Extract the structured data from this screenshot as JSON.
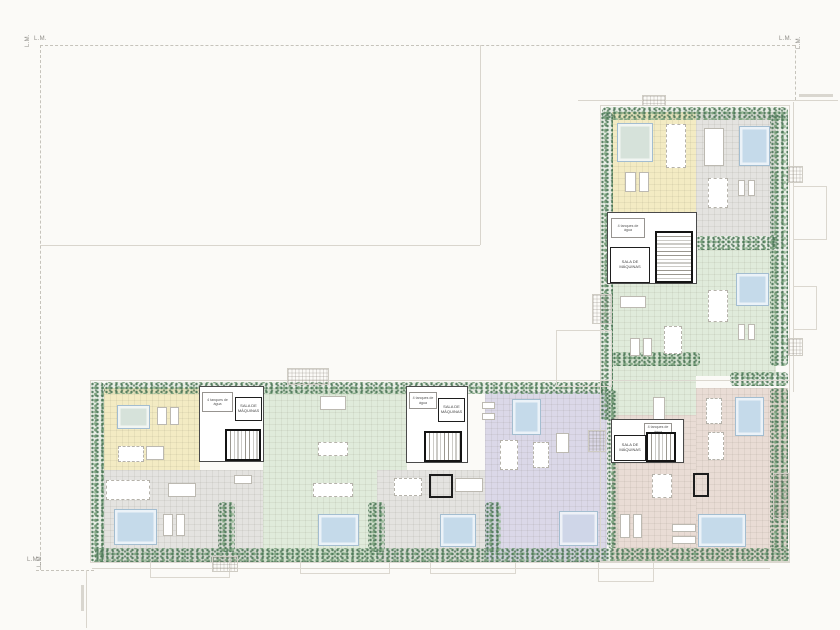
{
  "labels": {
    "lm": "L.M.",
    "sala_de_maquinas": "SALA DE\nMÁQUINAS",
    "tanques": "4 tanques de\nágua"
  },
  "palette": {
    "yellow": "#f3ebc3",
    "grey": "#e4e3e0",
    "green": "#e0ebdb",
    "purple": "#dbd8e8",
    "pink": "#e9dcd5",
    "pale": "#d6e2da",
    "blue": "#c5daea",
    "lav": "#cfd6e8",
    "boundary_dash": "#c6c3bb",
    "boundary_solid": "#d9d5cd"
  },
  "zones": [
    {
      "name": "yellow-north",
      "c": "yellow",
      "r": [
        612,
        112,
        84,
        102
      ]
    },
    {
      "name": "grey-north",
      "c": "grey",
      "r": [
        696,
        112,
        80,
        124
      ]
    },
    {
      "name": "green-north-right",
      "c": "green",
      "r": [
        696,
        250,
        80,
        126
      ]
    },
    {
      "name": "green-north-left",
      "c": "green",
      "r": [
        612,
        214,
        84,
        201
      ]
    },
    {
      "name": "pink-corner",
      "c": "pink",
      "r": [
        696,
        388,
        92,
        174
      ]
    },
    {
      "name": "pink-south",
      "c": "pink",
      "r": [
        612,
        415,
        84,
        147
      ]
    },
    {
      "name": "yellow-west",
      "c": "yellow",
      "r": [
        104,
        388,
        96,
        82
      ]
    },
    {
      "name": "grey-west",
      "c": "grey",
      "r": [
        104,
        470,
        159,
        92
      ]
    },
    {
      "name": "green-west",
      "c": "green",
      "r": [
        263,
        388,
        144,
        174
      ]
    },
    {
      "name": "grey-mid",
      "c": "grey",
      "r": [
        377,
        470,
        108,
        92
      ]
    },
    {
      "name": "purple",
      "c": "purple",
      "r": [
        485,
        392,
        122,
        170
      ]
    }
  ],
  "vegetation": [
    [
      602,
      107,
      186,
      13
    ],
    [
      600,
      112,
      13,
      308
    ],
    [
      770,
      114,
      18,
      252
    ],
    [
      696,
      236,
      80,
      14
    ],
    [
      730,
      372,
      58,
      14
    ],
    [
      612,
      352,
      88,
      14
    ],
    [
      770,
      388,
      18,
      162
    ],
    [
      104,
      382,
      503,
      12
    ],
    [
      90,
      382,
      14,
      180
    ],
    [
      95,
      548,
      695,
      14
    ],
    [
      218,
      502,
      17,
      50
    ],
    [
      368,
      502,
      17,
      50
    ],
    [
      485,
      502,
      16,
      50
    ],
    [
      607,
      390,
      11,
      158
    ]
  ],
  "pools": [
    {
      "r": [
        617,
        123,
        34,
        37
      ],
      "c": "pale"
    },
    {
      "r": [
        739,
        126,
        29,
        38
      ],
      "c": "blue"
    },
    {
      "r": [
        736,
        273,
        31,
        31
      ],
      "c": "blue"
    },
    {
      "r": [
        735,
        397,
        27,
        37
      ],
      "c": "blue"
    },
    {
      "r": [
        698,
        514,
        46,
        31
      ],
      "c": "blue"
    },
    {
      "r": [
        117,
        405,
        31,
        22
      ],
      "c": "pale"
    },
    {
      "r": [
        114,
        509,
        41,
        34
      ],
      "c": "blue"
    },
    {
      "r": [
        318,
        514,
        39,
        30
      ],
      "c": "blue"
    },
    {
      "r": [
        440,
        514,
        34,
        31
      ],
      "c": "blue"
    },
    {
      "r": [
        559,
        511,
        37,
        33
      ],
      "c": "lav"
    },
    {
      "r": [
        512,
        399,
        27,
        34
      ],
      "c": "blue"
    }
  ],
  "furniture": [
    {
      "t": "pair",
      "r": [
        625,
        172,
        24,
        20
      ]
    },
    {
      "t": "dots",
      "r": [
        666,
        124,
        20,
        44
      ]
    },
    {
      "t": "bar",
      "r": [
        704,
        128,
        20,
        38
      ]
    },
    {
      "t": "dots",
      "r": [
        708,
        178,
        20,
        30
      ]
    },
    {
      "t": "pair",
      "r": [
        738,
        180,
        17,
        16
      ]
    },
    {
      "t": "dots",
      "r": [
        708,
        290,
        20,
        32
      ]
    },
    {
      "t": "pair",
      "r": [
        738,
        324,
        17,
        16
      ]
    },
    {
      "t": "bar",
      "r": [
        620,
        296,
        26,
        12
      ]
    },
    {
      "t": "pair",
      "r": [
        630,
        338,
        22,
        18
      ]
    },
    {
      "t": "dots",
      "r": [
        664,
        326,
        18,
        28
      ]
    },
    {
      "t": "bar",
      "r": [
        653,
        397,
        12,
        24
      ]
    },
    {
      "t": "dots",
      "r": [
        706,
        398,
        16,
        26
      ]
    },
    {
      "t": "dots",
      "r": [
        708,
        432,
        16,
        28
      ]
    },
    {
      "t": "dots",
      "r": [
        652,
        474,
        20,
        24
      ]
    },
    {
      "t": "bar",
      "r": [
        672,
        524,
        24,
        8
      ]
    },
    {
      "t": "bar",
      "r": [
        672,
        536,
        24,
        8
      ]
    },
    {
      "t": "pair",
      "r": [
        620,
        514,
        22,
        24
      ]
    },
    {
      "t": "pair",
      "r": [
        157,
        407,
        22,
        18
      ]
    },
    {
      "t": "dots",
      "r": [
        118,
        446,
        26,
        16
      ]
    },
    {
      "t": "bar",
      "r": [
        146,
        446,
        18,
        14
      ]
    },
    {
      "t": "dots",
      "r": [
        106,
        480,
        44,
        20
      ]
    },
    {
      "t": "bar",
      "r": [
        168,
        483,
        28,
        14
      ]
    },
    {
      "t": "bar",
      "r": [
        234,
        475,
        18,
        9
      ]
    },
    {
      "t": "pair",
      "r": [
        163,
        514,
        22,
        22
      ]
    },
    {
      "t": "bar",
      "r": [
        320,
        396,
        26,
        14
      ]
    },
    {
      "t": "dots",
      "r": [
        318,
        442,
        30,
        14
      ]
    },
    {
      "t": "dots",
      "r": [
        313,
        483,
        40,
        14
      ]
    },
    {
      "t": "dots",
      "r": [
        394,
        478,
        28,
        18
      ]
    },
    {
      "t": "bar",
      "r": [
        455,
        478,
        28,
        14
      ]
    },
    {
      "t": "bar",
      "r": [
        482,
        402,
        13,
        7
      ]
    },
    {
      "t": "bar",
      "r": [
        482,
        413,
        13,
        7
      ]
    },
    {
      "t": "dots",
      "r": [
        500,
        440,
        18,
        30
      ]
    },
    {
      "t": "dots",
      "r": [
        533,
        442,
        16,
        26
      ]
    },
    {
      "t": "bar",
      "r": [
        556,
        433,
        13,
        20
      ]
    }
  ],
  "black_walls": [
    [
      693,
      473,
      16,
      24
    ],
    [
      429,
      474,
      24,
      24
    ]
  ],
  "faint_outlines": [
    [
      600,
      105,
      190,
      457
    ],
    [
      90,
      380,
      700,
      183
    ],
    [
      150,
      562,
      80,
      16
    ],
    [
      300,
      562,
      90,
      12
    ],
    [
      430,
      562,
      86,
      12
    ],
    [
      598,
      562,
      56,
      20
    ],
    [
      793,
      186,
      34,
      54
    ],
    [
      793,
      286,
      24,
      44
    ],
    [
      556,
      330,
      56,
      57
    ]
  ],
  "faint_grids": [
    [
      287,
      368,
      42,
      17
    ],
    [
      212,
      556,
      26,
      16
    ],
    [
      642,
      95,
      24,
      11
    ],
    [
      788,
      166,
      15,
      17
    ],
    [
      788,
      338,
      15,
      18
    ],
    [
      592,
      294,
      20,
      30
    ],
    [
      773,
      473,
      16,
      46
    ],
    [
      588,
      430,
      18,
      22
    ]
  ],
  "cores": [
    {
      "r": [
        607,
        212,
        90,
        72
      ],
      "tan": [
        3,
        5,
        34,
        20
      ],
      "sala": [
        2,
        34,
        40,
        36
      ],
      "stair": [
        47,
        18,
        38,
        52
      ],
      "st": "v"
    },
    {
      "r": [
        611,
        419,
        73,
        44
      ],
      "tan": [
        32,
        3,
        28,
        13
      ],
      "sala": [
        2,
        15,
        32,
        26
      ],
      "stair": [
        34,
        12,
        30,
        30
      ],
      "st": "h"
    },
    {
      "r": [
        199,
        386,
        65,
        76
      ],
      "tan": [
        2,
        5,
        31,
        20
      ],
      "sala": [
        35,
        10,
        27,
        24
      ],
      "stair": [
        25,
        42,
        36,
        32
      ],
      "st": "h"
    },
    {
      "r": [
        406,
        386,
        62,
        77
      ],
      "tan": [
        2,
        5,
        28,
        17
      ],
      "sala": [
        31,
        11,
        27,
        24
      ],
      "stair": [
        17,
        44,
        38,
        31
      ],
      "st": "h"
    }
  ],
  "boundary_lines": [
    [
      "h",
      40,
      45,
      755,
      "d"
    ],
    [
      "v",
      40,
      45,
      525,
      "d"
    ],
    [
      "h",
      40,
      245,
      440,
      "s"
    ],
    [
      "v",
      480,
      45,
      200,
      "s"
    ],
    [
      "h",
      36,
      570,
      58,
      "d"
    ],
    [
      "h",
      92,
      568,
      678,
      "s"
    ],
    [
      "v",
      86,
      570,
      58,
      "s"
    ],
    [
      "h",
      578,
      100,
      260,
      "s"
    ],
    [
      "v",
      795,
      45,
      55,
      "d"
    ],
    [
      "v",
      793,
      102,
      290,
      "s"
    ]
  ],
  "lm_marks": [
    {
      "p": [
        34,
        36
      ],
      "rot": 0
    },
    {
      "p": [
        25,
        47
      ],
      "rot": -90
    },
    {
      "p": [
        779,
        36
      ],
      "rot": 0
    },
    {
      "p": [
        796,
        49
      ],
      "rot": -90
    },
    {
      "p": [
        27,
        557
      ],
      "rot": 0
    },
    {
      "p": [
        37,
        567
      ],
      "rot": -90
    }
  ],
  "illegible_annotations": [
    [
      799,
      94,
      34,
      3
    ],
    [
      81,
      585,
      3,
      26
    ]
  ]
}
